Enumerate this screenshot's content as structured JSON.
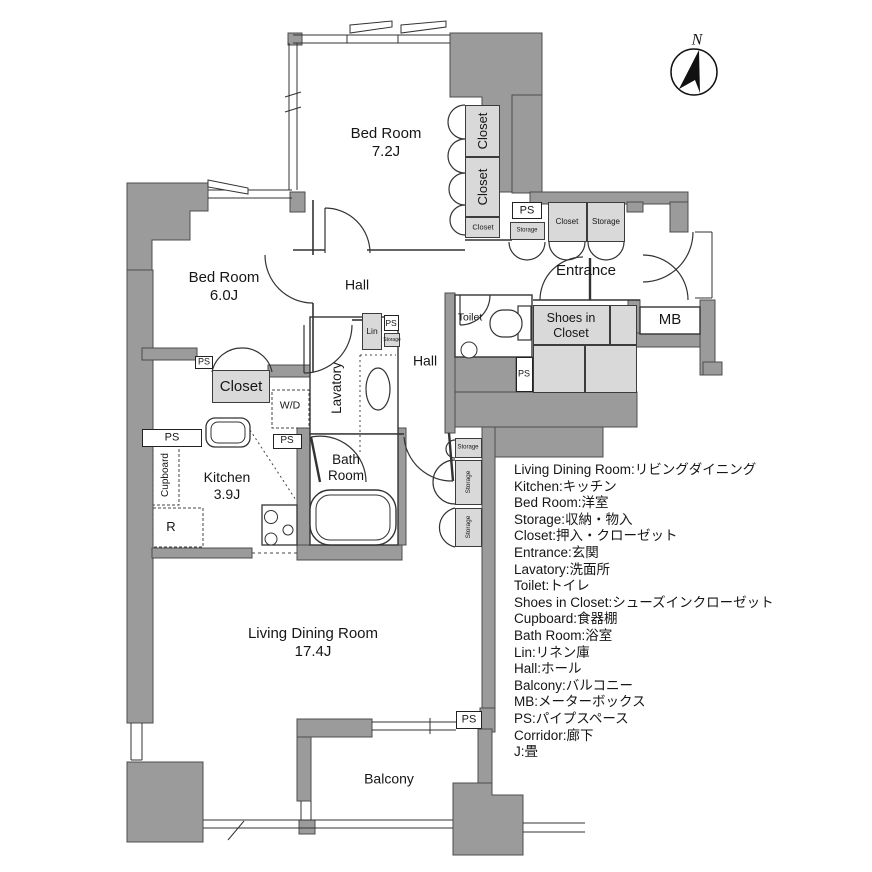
{
  "compass": {
    "north": "N"
  },
  "rooms": {
    "bedroom_7_2": {
      "name": "Bed Room",
      "size": "7.2J"
    },
    "bedroom_6_0": {
      "name": "Bed Room",
      "size": "6.0J"
    },
    "living": {
      "name": "Living Dining Room",
      "size": "17.4J"
    },
    "kitchen": {
      "name": "Kitchen",
      "size": "3.9J"
    },
    "bathroom": {
      "name": "Bath Room"
    },
    "hall": "Hall",
    "entrance": "Entrance",
    "toilet": "Toilet",
    "lavatory": "Lavatory",
    "balcony": "Balcony",
    "shoes_in_closet": "Shoes in Closet",
    "mb": "MB"
  },
  "labels": {
    "ps": "PS",
    "storage": "Storage",
    "closet": "Closet",
    "lin": "Lin",
    "washer_dryer": "W/D",
    "refrigerator": "R",
    "cupboard": "Cupboard"
  },
  "legend": {
    "items": [
      "Living Dining Room:リビングダイニング",
      "Kitchen:キッチン",
      "Bed Room:洋室",
      "Storage:収納・物入",
      "Closet:押入・クローゼット",
      "Entrance:玄関",
      "Lavatory:洗面所",
      "Toilet:トイレ",
      "Shoes in Closet:シューズインクローゼット",
      "Cupboard:食器棚",
      "Bath Room:浴室",
      "Lin:リネン庫",
      "Hall:ホール",
      "Balcony:バルコニー",
      "MB:メーターボックス",
      "PS:パイプスペース",
      "Corridor:廊下",
      "J:畳"
    ]
  },
  "colors": {
    "wall": "#9b9b9b",
    "fixture_box": "#d9d9d9",
    "line": "#333333"
  }
}
